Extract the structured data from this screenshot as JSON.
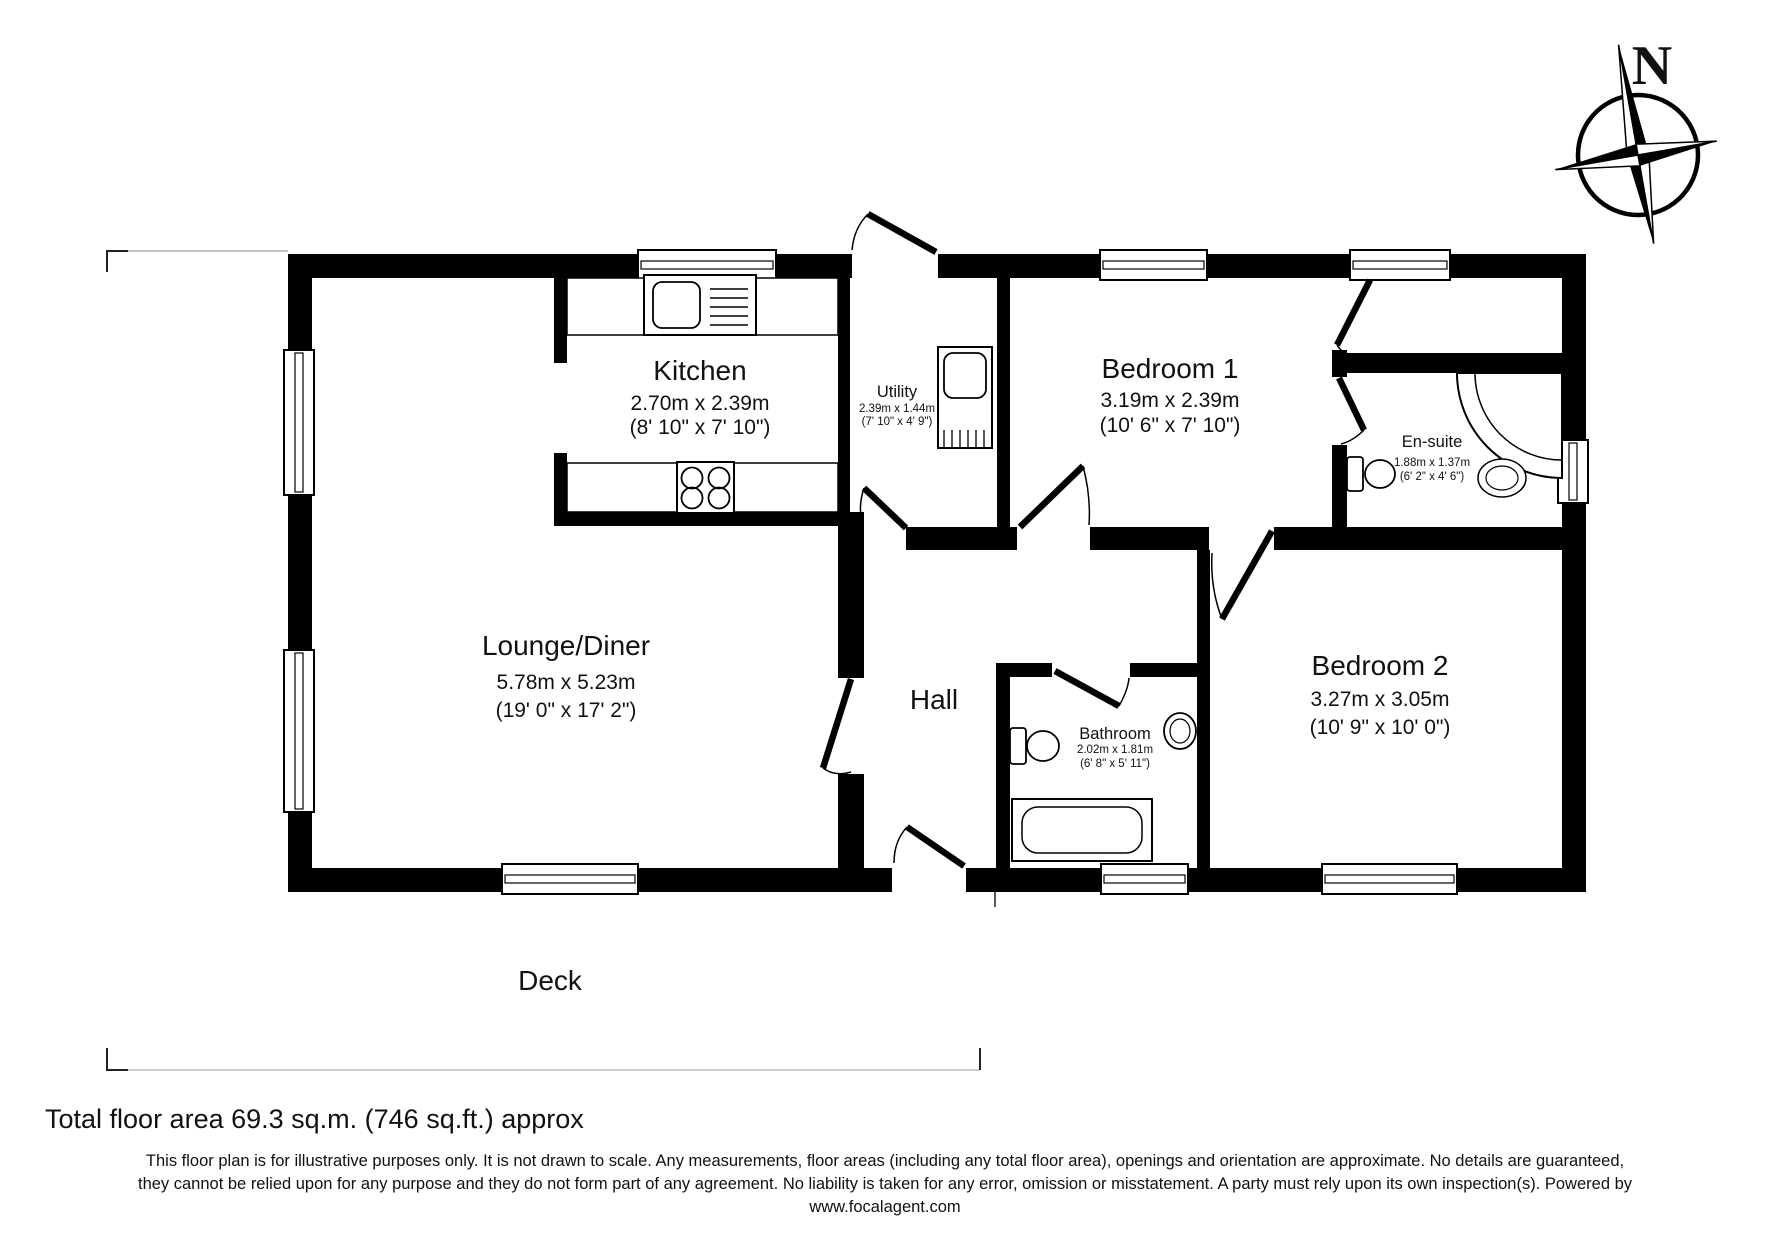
{
  "plan": {
    "rooms": {
      "lounge": {
        "name": "Lounge/Diner",
        "metric": "5.78m x 5.23m",
        "imperial": "(19' 0\" x 17' 2\")"
      },
      "kitchen": {
        "name": "Kitchen",
        "metric": "2.70m x 2.39m",
        "imperial": "(8' 10\" x 7' 10\")"
      },
      "utility": {
        "name": "Utility",
        "metric": "2.39m x 1.44m",
        "imperial": "(7' 10\" x 4' 9\")"
      },
      "bedroom1": {
        "name": "Bedroom 1",
        "metric": "3.19m x 2.39m",
        "imperial": "(10' 6\" x 7' 10\")"
      },
      "ensuite": {
        "name": "En-suite",
        "metric": "1.88m x 1.37m",
        "imperial": "(6' 2\" x 4' 6\")"
      },
      "hall": {
        "name": "Hall"
      },
      "bathroom": {
        "name": "Bathroom",
        "metric": "2.02m x 1.81m",
        "imperial": "(6' 8\" x 5' 11\")"
      },
      "bedroom2": {
        "name": "Bedroom 2",
        "metric": "3.27m x 3.05m",
        "imperial": "(10' 9\" x 10' 0\")"
      }
    },
    "deck_label": "Deck",
    "compass_north": "N",
    "colors": {
      "wall": "#000000",
      "background": "#ffffff"
    }
  },
  "footer": {
    "total_area": "Total floor area 69.3 sq.m. (746 sq.ft.) approx",
    "disclaimer_line1": "This floor plan is for illustrative purposes only. It is not drawn to scale. Any measurements, floor areas (including any total floor area), openings and orientation are approximate. No details are guaranteed,",
    "disclaimer_line2": "they cannot be relied upon for any purpose and they do not form part of any agreement. No liability is taken for any error, omission or misstatement. A party must rely upon its own inspection(s).  Powered by",
    "disclaimer_line3": "www.focalagent.com"
  }
}
